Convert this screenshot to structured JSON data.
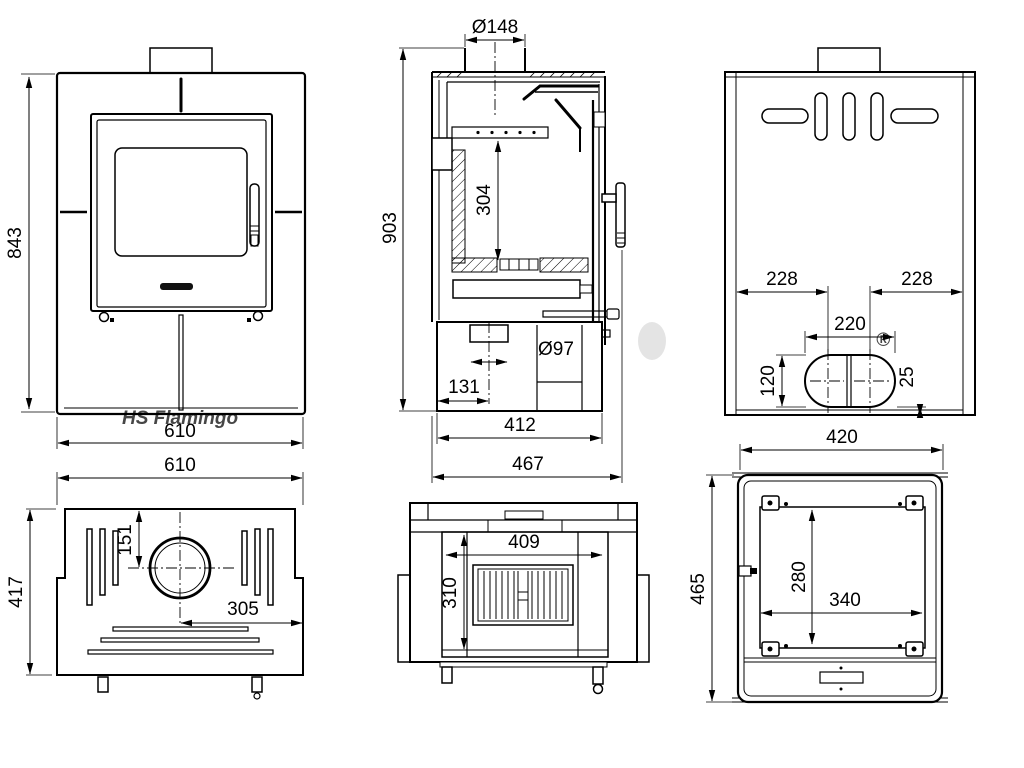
{
  "watermark": {
    "text": "HS Flamingo",
    "registered_mark": "®"
  },
  "colors": {
    "watermark_pink": "#f5b8b8",
    "flame_dot_gray": "#d9d9d9",
    "line": "#000000"
  },
  "front_view": {
    "height": "843",
    "width": "610"
  },
  "section_view": {
    "flue_diameter": "Ø148",
    "overall_height": "903",
    "firebox_height": "304",
    "bottom_outlet_diameter": "Ø97",
    "bottom_outlet_offset": "131",
    "body_depth": "412",
    "overall_depth": "467"
  },
  "rear_view": {
    "offset_left": "228",
    "offset_right": "228",
    "opening_width": "220",
    "opening_height": "120",
    "bottom_clearance": "25"
  },
  "top_view": {
    "width": "610",
    "depth": "417",
    "flue_from_rear": "151",
    "flue_from_side": "305"
  },
  "open_front_view": {
    "opening_width": "409",
    "opening_height": "310"
  },
  "bottom_view": {
    "width": "420",
    "depth": "465",
    "mount_span_width": "340",
    "mount_span_depth": "280"
  }
}
